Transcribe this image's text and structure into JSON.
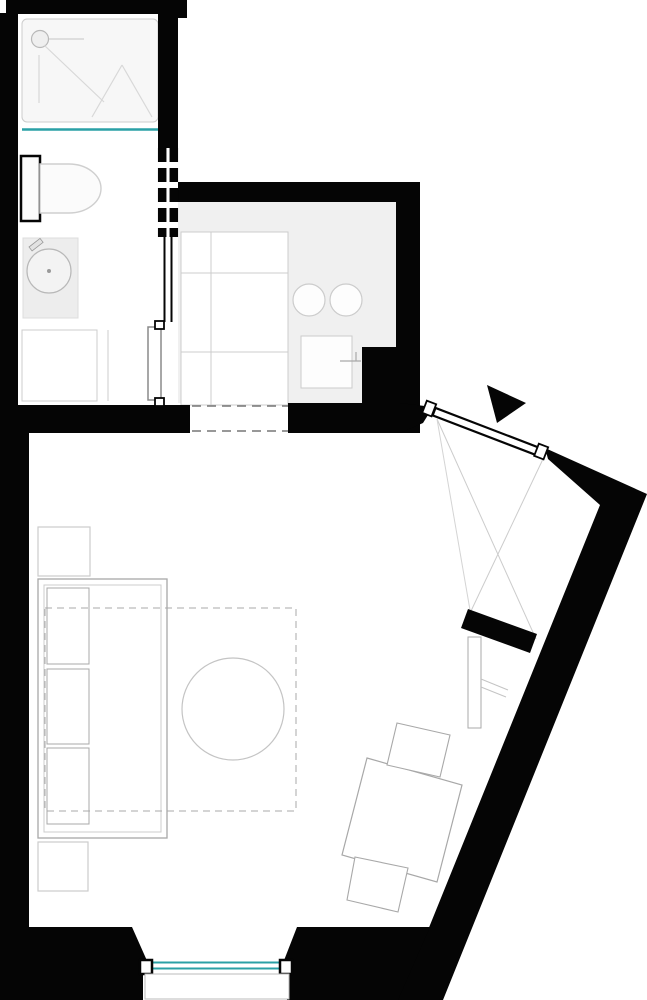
{
  "meta": {
    "kind": "architectural-floor-plan",
    "visible_text": "",
    "canvas": {
      "width": 647,
      "height": 1000
    }
  },
  "colors": {
    "paper": "#ffffff",
    "wall": "#050505",
    "accent": "#2aa0a6",
    "floor-kitchen": "#f0f0f0",
    "fixture-fill": "#f7f7f7",
    "line-light": "#cccccc",
    "line-mid": "#a8a8a8",
    "dash-line": "#777777"
  },
  "symbols": {
    "entrance_arrow": "filled-black-triangle",
    "window_glazing": "double-teal-line",
    "shower_screen": "teal-line",
    "sofa_bed_outline": "dashed-rectangle",
    "wardrobe": "crossed-diagonal-lines",
    "open_passage": "dashed-threshold-lines"
  }
}
